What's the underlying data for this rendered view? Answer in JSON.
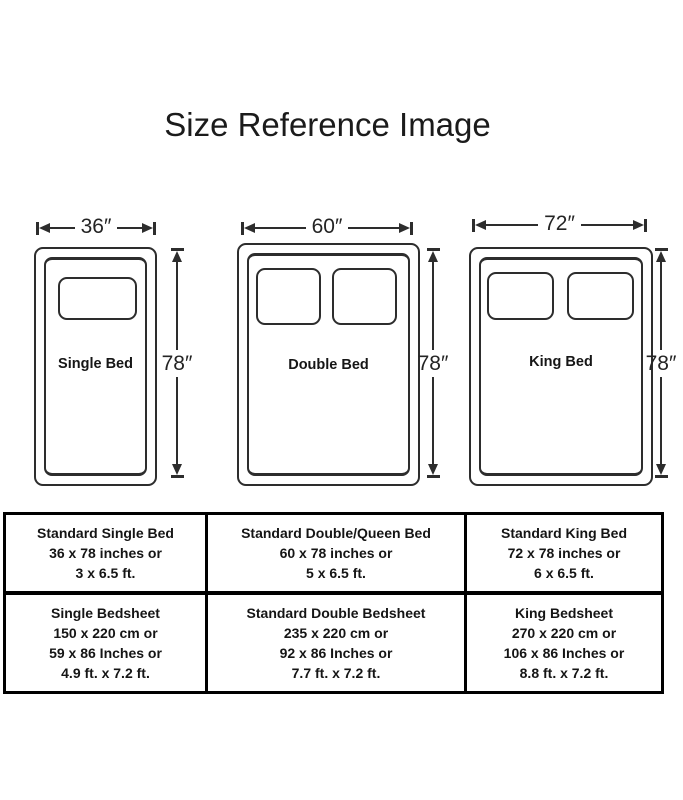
{
  "title": "Size Reference Image",
  "beds": [
    {
      "name": "Single Bed",
      "width_label": "36″",
      "height_label": "78″",
      "pillows": 1
    },
    {
      "name": "Double Bed",
      "width_label": "60″",
      "height_label": "78″",
      "pillows": 2
    },
    {
      "name": "King Bed",
      "width_label": "72″",
      "height_label": "78″",
      "pillows": 2
    }
  ],
  "table": {
    "rows": [
      {
        "cells": [
          {
            "lines": [
              "Standard Single Bed",
              "36 x 78 inches or",
              "3 x 6.5 ft.",
              ""
            ]
          },
          {
            "lines": [
              "Standard Double/Queen Bed",
              "60 x 78 inches or",
              "5 x 6.5 ft.",
              ""
            ]
          },
          {
            "lines": [
              "Standard King Bed",
              "72 x 78 inches or",
              "6 x 6.5 ft.",
              ""
            ]
          }
        ]
      },
      {
        "cells": [
          {
            "lines": [
              "Single Bedsheet",
              "150 x 220 cm or",
              "59 x 86 Inches or",
              "4.9 ft. x 7.2 ft."
            ]
          },
          {
            "lines": [
              "Standard Double Bedsheet",
              "235 x 220 cm or",
              "92 x 86 Inches or",
              "7.7 ft. x 7.2 ft."
            ]
          },
          {
            "lines": [
              "King Bedsheet",
              "270 x 220 cm or",
              "106 x 86 Inches or",
              "8.8 ft. x 7.2 ft."
            ]
          }
        ]
      }
    ]
  },
  "colors": {
    "line": "#2d2d2d",
    "text": "#161616",
    "table_border": "#000000",
    "background": "#ffffff"
  }
}
